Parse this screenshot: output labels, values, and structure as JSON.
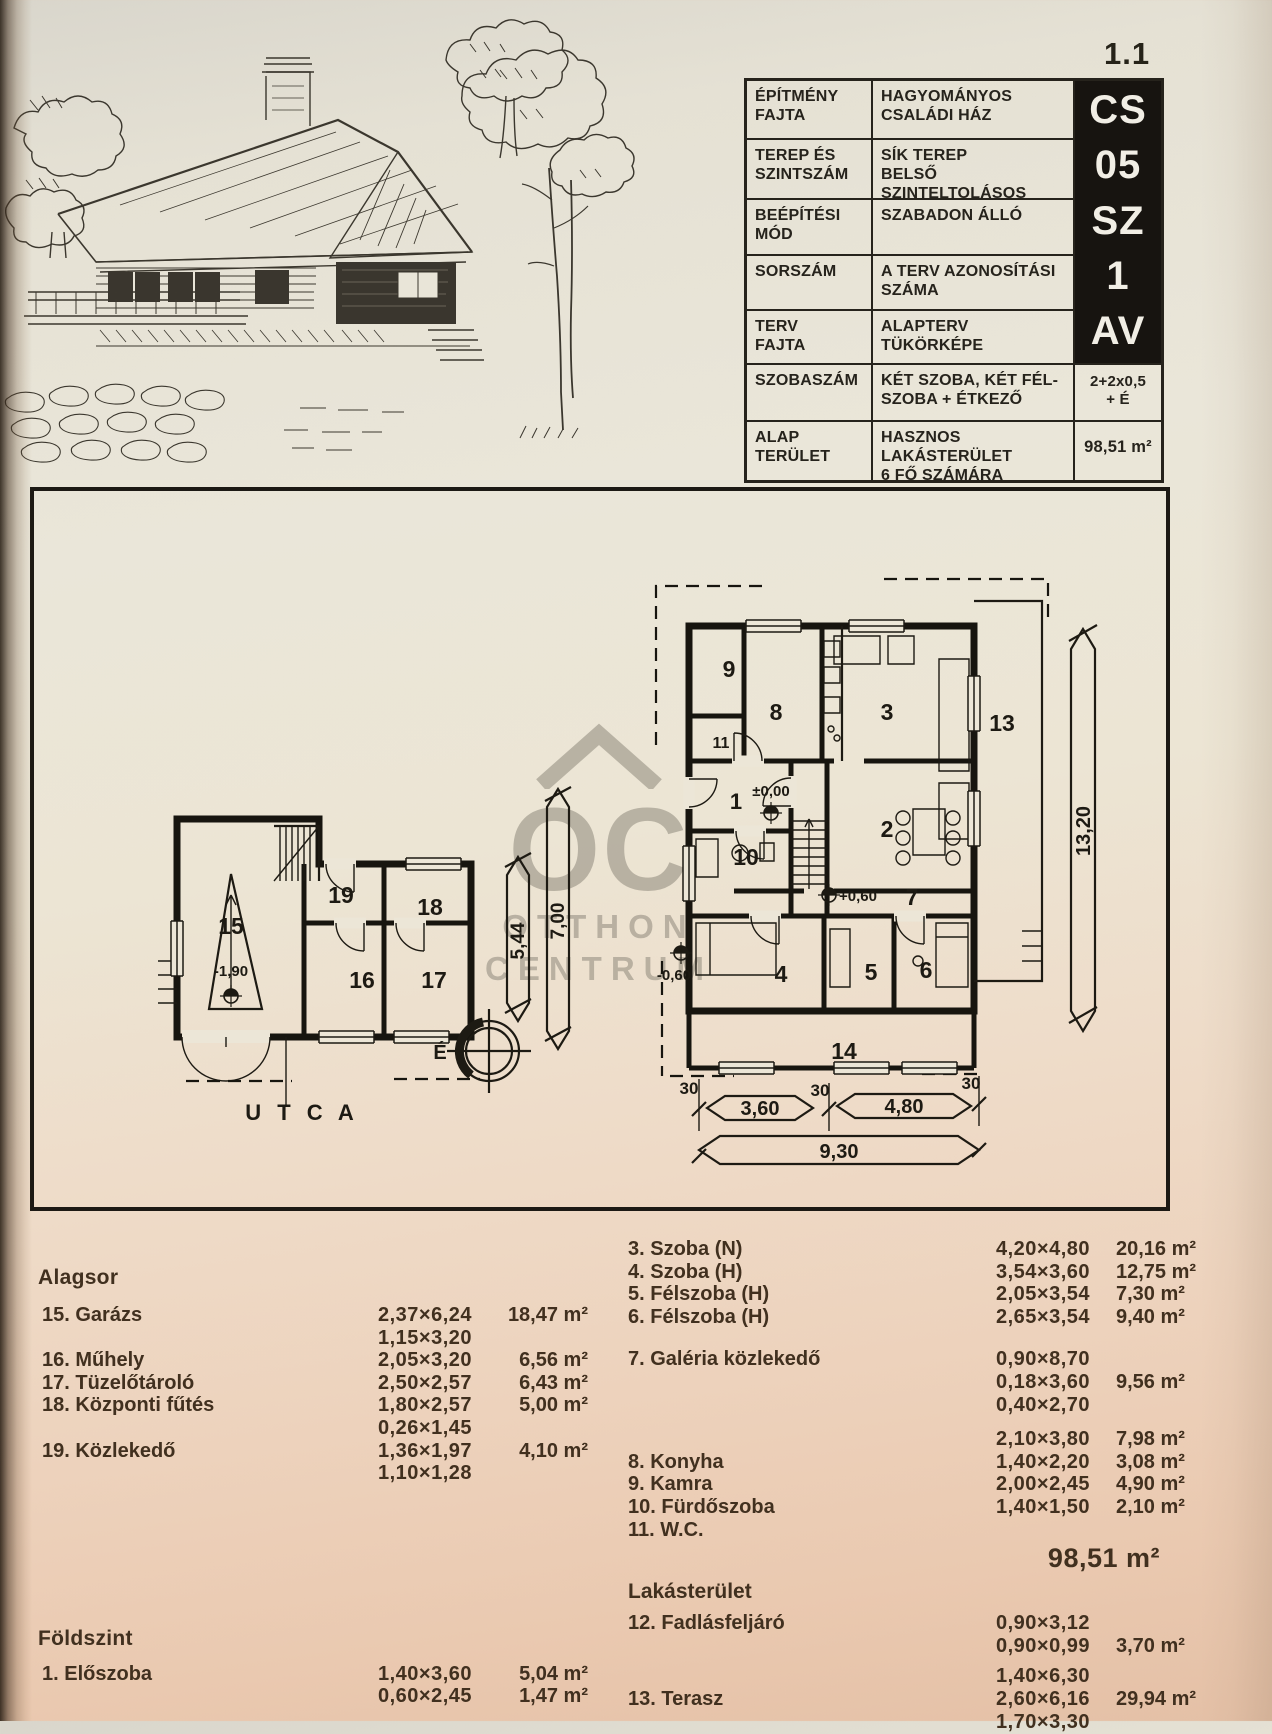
{
  "page": {
    "number": "1.1"
  },
  "colors": {
    "paper_top": "#dcd9d0",
    "paper_bottom": "#e5c1a6",
    "ink": "#26231c",
    "schedule_ink": "#41301f",
    "code_block_bg": "#171410",
    "code_block_text": "#f1eee5",
    "watermark_gray": "#8f897c"
  },
  "spec_table": {
    "rows": [
      {
        "label": "ÉPÍTMÉNY\nFAJTA",
        "value": "HAGYOMÁNYOS\nCSALÁDI HÁZ"
      },
      {
        "label": "TEREP ÉS\nSZINTSZÁM",
        "value": "SÍK TEREP\nBELSŐ SZINTELTOLÁSOS"
      },
      {
        "label": "BEÉPÍTÉSI\nMÓD",
        "value": "SZABADON ÁLLÓ"
      },
      {
        "label": "SORSZÁM",
        "value": "A TERV AZONOSÍTÁSI\nSZÁMA"
      },
      {
        "label": "TERV\nFAJTA",
        "value": "ALAPTERV\nTÜKÖRKÉPE"
      },
      {
        "label": "SZOBASZÁM",
        "value": "KÉT SZOBA, KÉT FÉL-\nSZOBA + ÉTKEZŐ",
        "code": "2+2x0,5\n+ É"
      },
      {
        "label": "ALAP\nTERÜLET",
        "value": "HASZNOS LAKÁSTERÜLET\n6 FŐ SZÁMÁRA",
        "code": "98,51 m²"
      }
    ],
    "codes": [
      "CS",
      "05",
      "SZ",
      "1",
      "AV"
    ]
  },
  "watermark": {
    "monogram": "OC",
    "line1": "OTTHON",
    "line2": "CENTRUM"
  },
  "plan": {
    "labels": {
      "r1": "1",
      "r2": "2",
      "r3": "3",
      "r4": "4",
      "r5": "5",
      "r6": "6",
      "r7": "7",
      "r8": "8",
      "r9": "9",
      "r10": "10",
      "r11": "11",
      "r13": "13",
      "r14": "14",
      "r15": "15",
      "r16": "16",
      "r17": "17",
      "r18": "18",
      "r19": "19",
      "lvl_zero": "±0,00",
      "lvl_plus": "+0,60",
      "lvl_minus": "-0,60",
      "lvl_garage": "-1,90",
      "utca": "U T C A",
      "north": "É",
      "d544": "5,44",
      "d700": "7,00",
      "d1320": "13,20",
      "d360": "3,60",
      "d480": "4,80",
      "d930": "9,30",
      "t30a": "30",
      "t30b": "30",
      "t30c": "30"
    }
  },
  "schedule": {
    "alagsor": {
      "heading": "Alagsor",
      "rows": [
        {
          "name": "15. Garázs",
          "dim": "2,37×6,24",
          "area": "18,47 m²"
        },
        {
          "name": "",
          "dim": "1,15×3,20",
          "area": ""
        },
        {
          "name": "16. Műhely",
          "dim": "2,05×3,20",
          "area": "6,56 m²"
        },
        {
          "name": "17. Tüzelőtároló",
          "dim": "2,50×2,57",
          "area": "6,43 m²"
        },
        {
          "name": "18. Központi fűtés",
          "dim": "1,80×2,57",
          "area": "5,00 m²"
        },
        {
          "name": "",
          "dim": "0,26×1,45",
          "area": ""
        },
        {
          "name": "19. Közlekedő",
          "dim": "1,36×1,97",
          "area": "4,10 m²"
        },
        {
          "name": "",
          "dim": "1,10×1,28",
          "area": ""
        }
      ]
    },
    "foldszint": {
      "heading": "Földszint",
      "rows": [
        {
          "name": "1. Előszoba",
          "dim": "1,40×3,60",
          "area": "5,04 m²"
        },
        {
          "name": "",
          "dim": "0,60×2,45",
          "area": "1,47 m²"
        }
      ]
    },
    "rooms_a": {
      "rows": [
        {
          "name": "3. Szoba (N)",
          "dim": "4,20×4,80",
          "area": "20,16 m²"
        },
        {
          "name": "4. Szoba (H)",
          "dim": "3,54×3,60",
          "area": "12,75 m²"
        },
        {
          "name": "5. Félszoba (H)",
          "dim": "2,05×3,54",
          "area": "7,30 m²"
        },
        {
          "name": "6. Félszoba (H)",
          "dim": "2,65×3,54",
          "area": "9,40 m²"
        }
      ]
    },
    "rooms_b": {
      "rows": [
        {
          "name": "7. Galéria közlekedő",
          "dim": "0,90×8,70",
          "area": ""
        },
        {
          "name": "",
          "dim": "0,18×3,60",
          "area": "9,56 m²"
        },
        {
          "name": "",
          "dim": "0,40×2,70",
          "area": ""
        }
      ]
    },
    "rooms_c": {
      "rows": [
        {
          "name": "",
          "dim": "2,10×3,80",
          "area": "7,98 m²"
        },
        {
          "name": "8. Konyha",
          "dim": "1,40×2,20",
          "area": "3,08 m²"
        },
        {
          "name": "9. Kamra",
          "dim": "2,00×2,45",
          "area": "4,90 m²"
        },
        {
          "name": "10. Fürdőszoba",
          "dim": "1,40×1,50",
          "area": "2,10 m²"
        },
        {
          "name": "11. W.C.",
          "dim": "",
          "area": ""
        }
      ]
    },
    "total": {
      "area": "98,51 m²",
      "label": "Lakásterület"
    },
    "rooms_d": {
      "rows": [
        {
          "name": "12. Fadlásfeljáró",
          "dim": "0,90×3,12",
          "area": ""
        },
        {
          "name": "",
          "dim": "0,90×0,99",
          "area": "3,70 m²"
        }
      ]
    },
    "rooms_e": {
      "rows": [
        {
          "name": "",
          "dim": "1,40×6,30",
          "area": ""
        },
        {
          "name": "13. Terasz",
          "dim": "2,60×6,16",
          "area": "29,94 m²"
        },
        {
          "name": "",
          "dim": "1,70×3,30",
          "area": ""
        }
      ]
    }
  }
}
